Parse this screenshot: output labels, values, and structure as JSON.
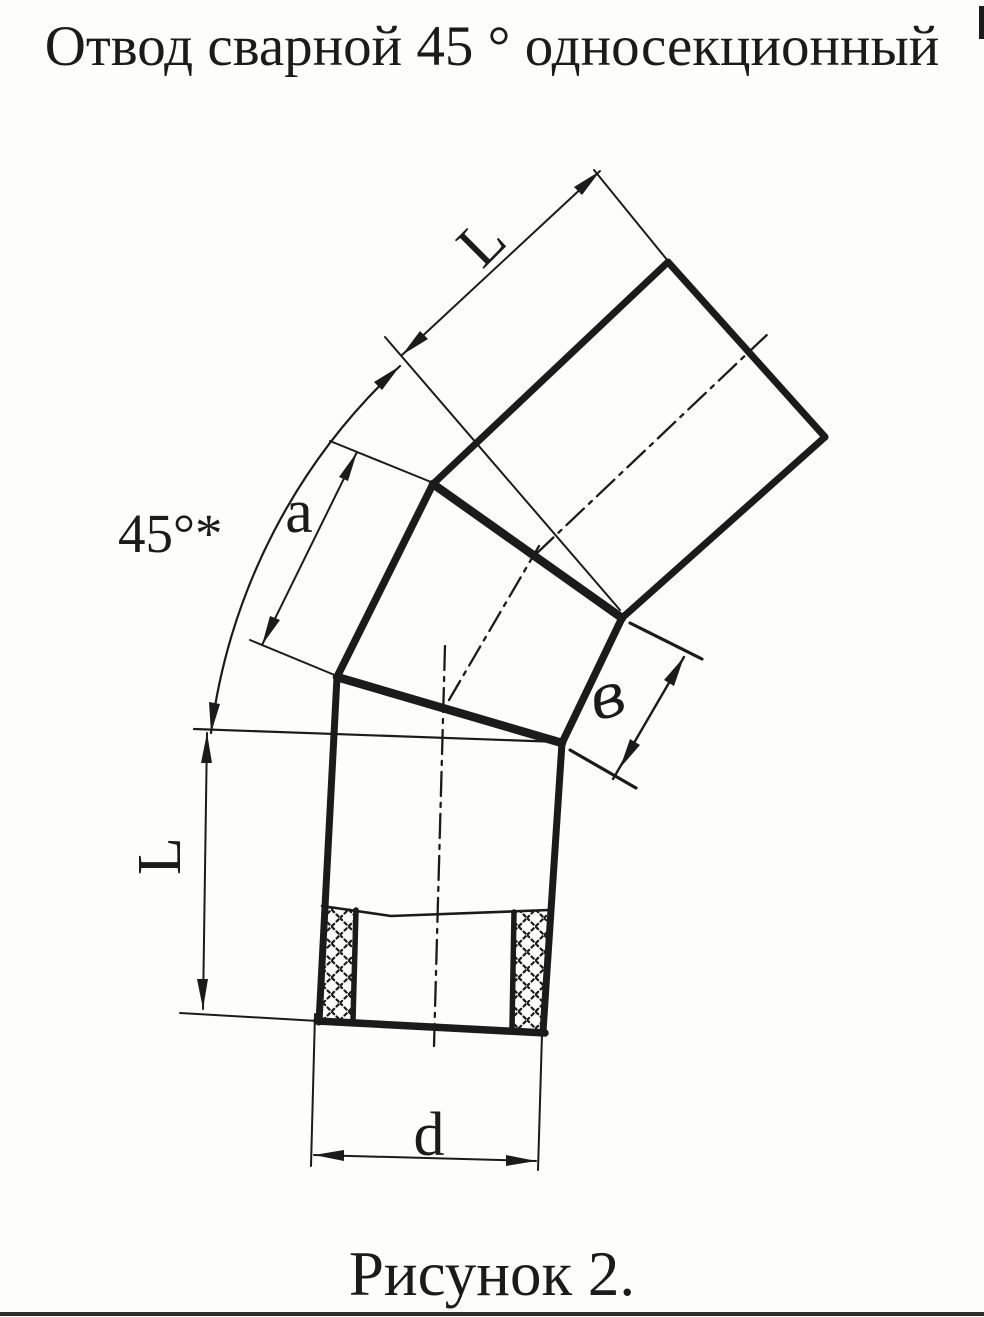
{
  "page": {
    "title": "Отвод сварной 45 ° односекционный",
    "caption": "Рисунок 2."
  },
  "drawing": {
    "dimension_labels": {
      "pipe_length": "L",
      "section_side": "a",
      "bend_angle": "45°*",
      "section_edge": "в",
      "diameter": "d"
    },
    "colors": {
      "ink": "#1b1b1b",
      "paper": "#fdfdfc"
    }
  }
}
